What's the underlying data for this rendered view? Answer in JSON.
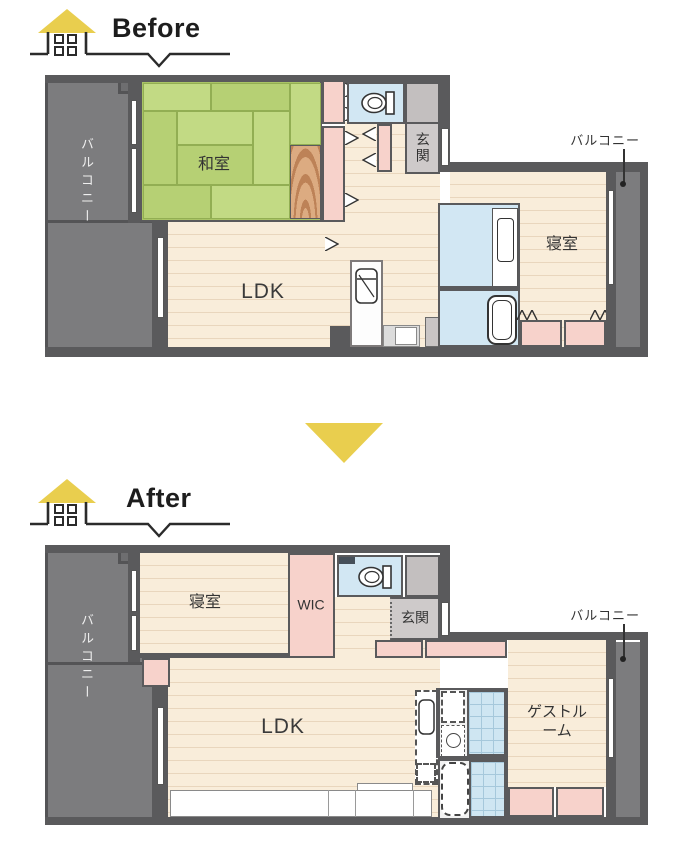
{
  "before": {
    "label": "Before",
    "balcony_left": "バルコニー",
    "balcony_right": "バルコニー",
    "rooms": {
      "washitsu": "和室",
      "genkan": "玄関",
      "bedroom": "寝室",
      "ldk": "LDK"
    }
  },
  "after": {
    "label": "After",
    "balcony_left": "バルコニー",
    "balcony_right": "バルコニー",
    "rooms": {
      "bedroom": "寝室",
      "wic": "WIC",
      "genkan": "玄関",
      "ldk": "LDK",
      "guest_room": "ゲストルーム"
    }
  },
  "colors": {
    "accent_yellow": "#e9ce4e",
    "wall_gray": "#5a5a5c",
    "balcony_gray": "#7c7c7e",
    "tatami_green": "#b6d074",
    "closet_pink": "#f7d2cb",
    "water_blue": "#d2e7f3",
    "wood_floor": "#f9edda"
  }
}
